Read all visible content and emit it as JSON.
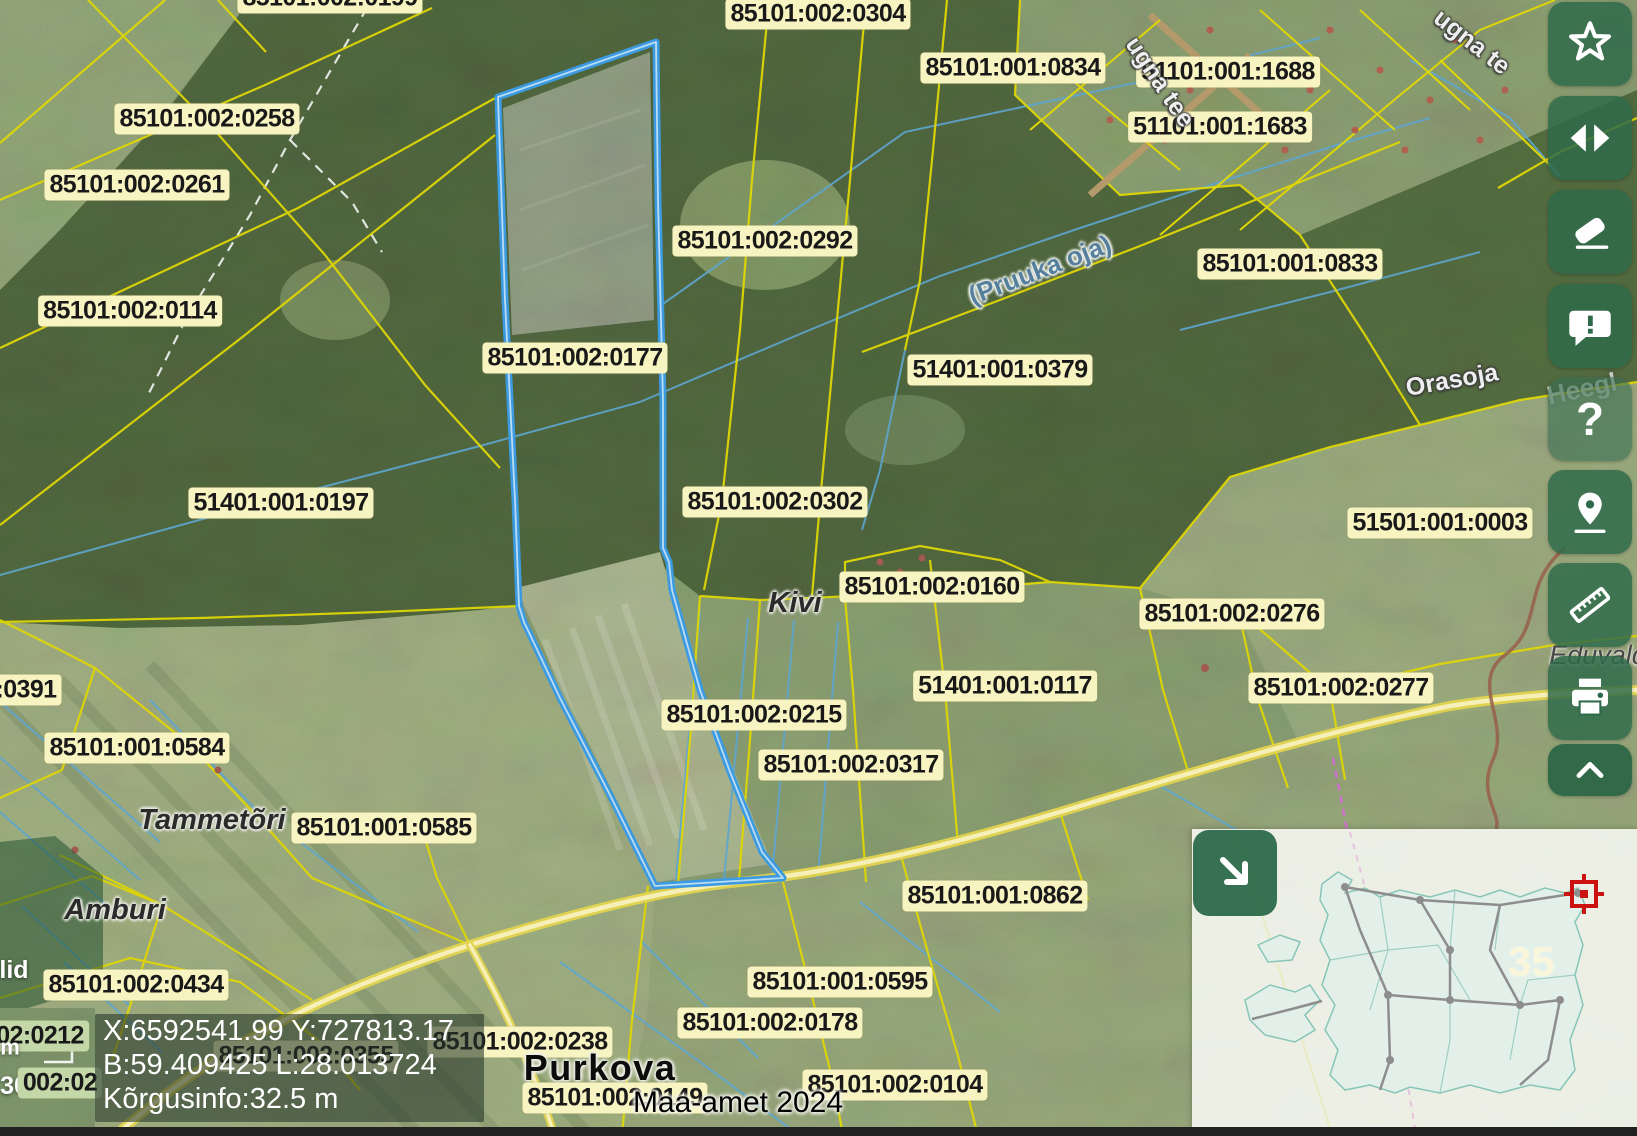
{
  "map": {
    "labels": [
      {
        "t": "85101:002:0199",
        "k": "parcel",
        "x": 330,
        "y": -2
      },
      {
        "t": "85101:002:0304",
        "k": "parcel",
        "x": 818,
        "y": 14
      },
      {
        "t": "85101:001:0834",
        "k": "parcel",
        "x": 1013,
        "y": 68
      },
      {
        "t": "51101:001:1688",
        "k": "parcel",
        "x": 1228,
        "y": 72
      },
      {
        "t": "51101:001:1683",
        "k": "parcel",
        "x": 1220,
        "y": 127
      },
      {
        "t": "85101:002:0258",
        "k": "parcel",
        "x": 207,
        "y": 119
      },
      {
        "t": "85101:002:0261",
        "k": "parcel",
        "x": 137,
        "y": 185
      },
      {
        "t": "85101:002:0114",
        "k": "parcel",
        "x": 130,
        "y": 311
      },
      {
        "t": "85101:002:0292",
        "k": "parcel",
        "x": 765,
        "y": 241
      },
      {
        "t": "85101:001:0833",
        "k": "parcel",
        "x": 1290,
        "y": 264
      },
      {
        "t": "(Pruuka oja)",
        "k": "water",
        "x": 1040,
        "y": 270,
        "r": -21
      },
      {
        "t": "ugna tee",
        "k": "roadname",
        "x": 1160,
        "y": 82,
        "r": 56
      },
      {
        "t": "ugna te",
        "k": "roadname",
        "x": 1472,
        "y": 42,
        "r": 38
      },
      {
        "t": "85101:002:0177",
        "k": "parcel",
        "x": 575,
        "y": 358
      },
      {
        "t": "51401:001:0379",
        "k": "parcel",
        "x": 1000,
        "y": 370
      },
      {
        "t": "51401:001:0197",
        "k": "parcel",
        "x": 281,
        "y": 503
      },
      {
        "t": "85101:002:0302",
        "k": "parcel",
        "x": 775,
        "y": 502
      },
      {
        "t": "85101:002:0160",
        "k": "parcel",
        "x": 932,
        "y": 587
      },
      {
        "t": "Kivi",
        "k": "place",
        "x": 795,
        "y": 603
      },
      {
        "t": "Orasoja",
        "k": "roadname",
        "x": 1452,
        "y": 380,
        "r": -10
      },
      {
        "t": "Heegl",
        "k": "ghost",
        "x": 1582,
        "y": 389,
        "r": -12
      },
      {
        "t": "51501:001:0003",
        "k": "parcel",
        "x": 1440,
        "y": 523
      },
      {
        "t": "85101:002:0276",
        "k": "parcel",
        "x": 1232,
        "y": 614
      },
      {
        "t": "Eduvald",
        "k": "place2",
        "x": 1598,
        "y": 655
      },
      {
        "t": "85101:002:0277",
        "k": "parcel",
        "x": 1341,
        "y": 688
      },
      {
        "t": "51401:001:0117",
        "k": "parcel",
        "x": 1005,
        "y": 686
      },
      {
        "t": "85101:002:0215",
        "k": "parcel",
        "x": 754,
        "y": 715
      },
      {
        "t": "85101:002:0317",
        "k": "parcel",
        "x": 851,
        "y": 765
      },
      {
        "t": ":0391",
        "k": "parcel",
        "x": 26,
        "y": 690
      },
      {
        "t": "85101:001:0584",
        "k": "parcel",
        "x": 137,
        "y": 748
      },
      {
        "t": "Tammetõri",
        "k": "place",
        "x": 212,
        "y": 820
      },
      {
        "t": "85101:001:0585",
        "k": "parcel",
        "x": 384,
        "y": 828
      },
      {
        "t": "Amburi",
        "k": "place",
        "x": 115,
        "y": 910
      },
      {
        "t": "85101:002:0434",
        "k": "parcel",
        "x": 136,
        "y": 985
      },
      {
        "t": "lid",
        "k": "white",
        "x": 14,
        "y": 970
      },
      {
        "t": "02:0212",
        "k": "parcel tint",
        "x": 40,
        "y": 1036
      },
      {
        "t": "m",
        "k": "white",
        "x": 10,
        "y": 1048,
        "s": 22
      },
      {
        "t": "30",
        "k": "white",
        "x": 14,
        "y": 1086
      },
      {
        "t": "002:02",
        "k": "parcel tint",
        "x": 60,
        "y": 1083
      },
      {
        "t": "85101:002:0238",
        "k": "parcel",
        "x": 520,
        "y": 1042
      },
      {
        "t": "85101:002:0355",
        "k": "parcel",
        "x": 306,
        "y": 1056
      },
      {
        "t": "85101:001:0862",
        "k": "parcel",
        "x": 995,
        "y": 896
      },
      {
        "t": "85101:001:0595",
        "k": "parcel",
        "x": 840,
        "y": 982
      },
      {
        "t": "85101:002:0178",
        "k": "parcel",
        "x": 770,
        "y": 1023
      },
      {
        "t": "Purkova",
        "k": "town",
        "x": 600,
        "y": 1068
      },
      {
        "t": "85101:002:0149",
        "k": "parcel",
        "x": 615,
        "y": 1098
      },
      {
        "t": "85101:002:0104",
        "k": "parcel",
        "x": 895,
        "y": 1085
      },
      {
        "t": "Maa-amet 2024",
        "k": "attribution",
        "x": 738,
        "y": 1103
      }
    ]
  },
  "status_overlay": {
    "line1": "X:6592541.99 Y:727813.17",
    "line2": "B:59.409425 L:28.013724",
    "line3": "Kõrgusinfo:32.5 m"
  },
  "toolbar": {
    "buttons": [
      "star-icon",
      "compare-swipe-icon",
      "eraser-icon",
      "feedback-icon",
      "help-icon",
      "location-pin-icon",
      "ruler-icon",
      "printer-icon",
      "collapse-chevron-icon"
    ],
    "help_glyph": "?"
  },
  "minimap": {
    "expand_icon": "arrow-down-right-icon",
    "region_label": "35"
  },
  "colors": {
    "toolbar_green": "#2f6a4a",
    "label_background": "#f8f4c2",
    "selection_blue": "#3b9ae0",
    "cadastral_yellow": "#ded606",
    "road_yellow": "#e3d44f",
    "water_blue": "#5ea6cf"
  }
}
